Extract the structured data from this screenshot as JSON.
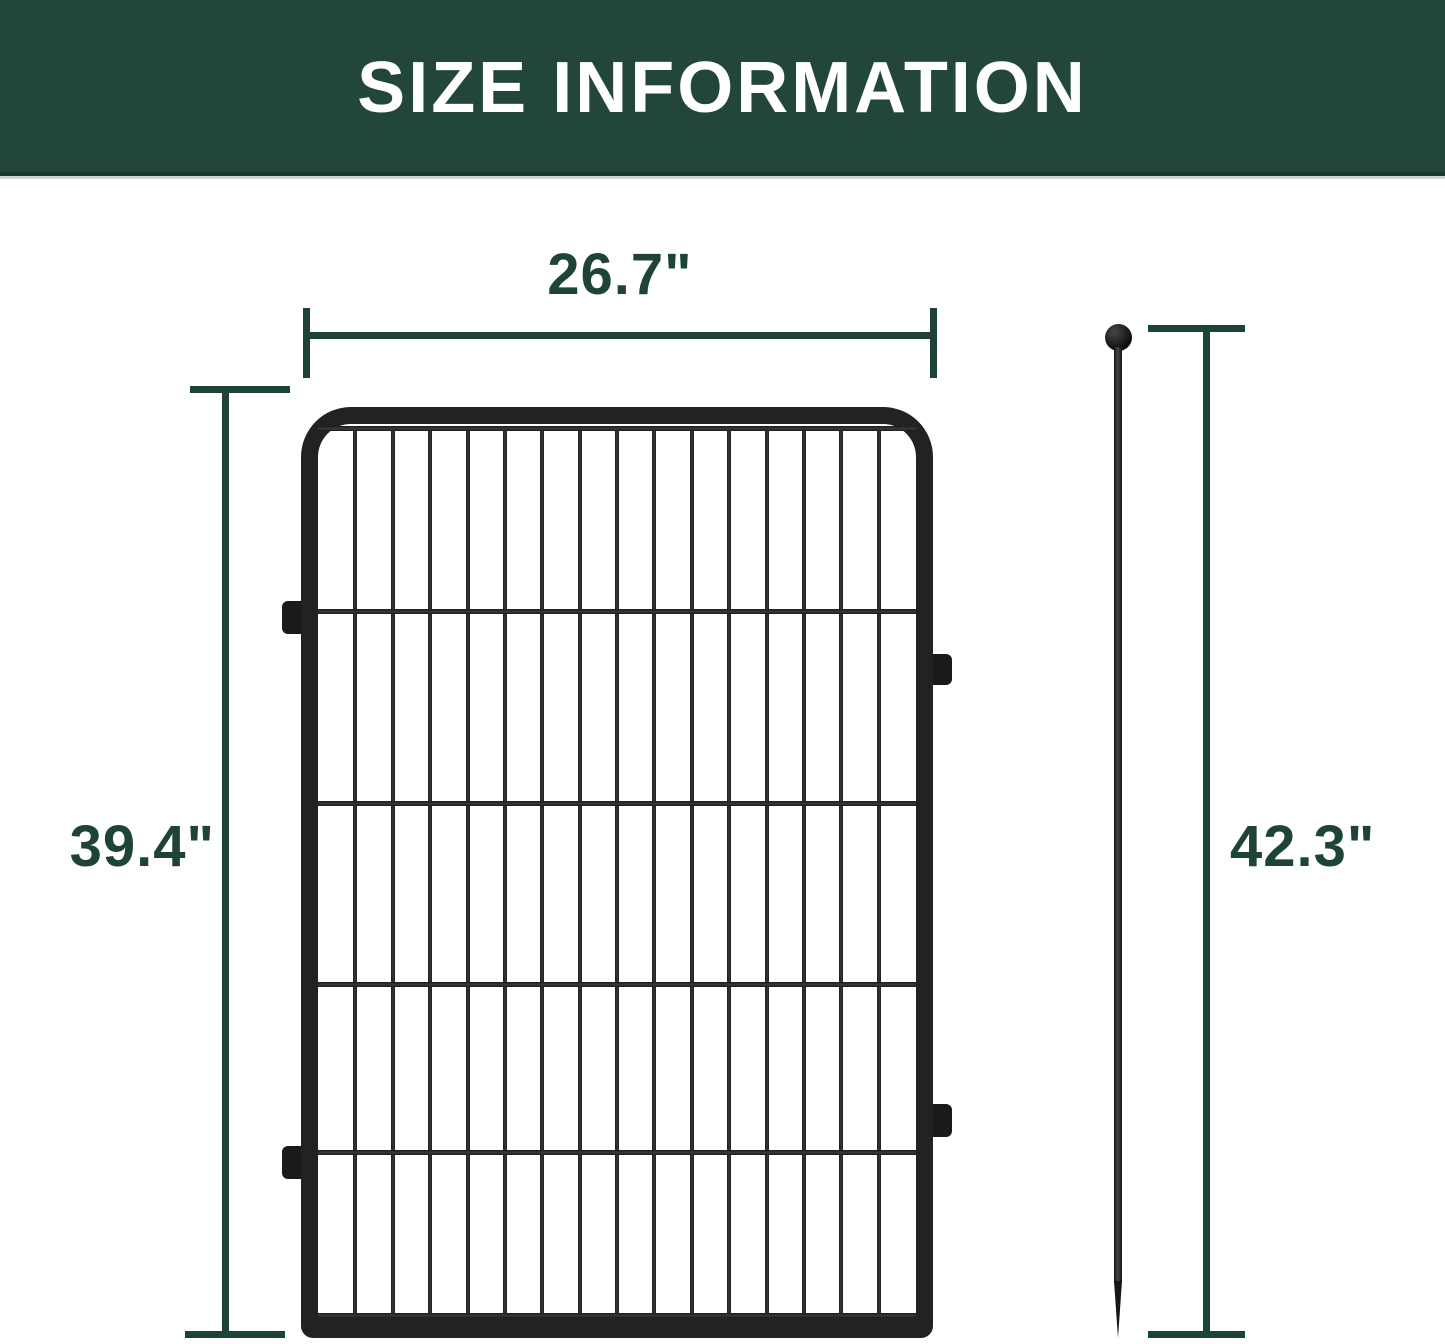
{
  "header": {
    "title": "SIZE INFORMATION"
  },
  "colors": {
    "banner_bg": "#224739",
    "banner_text": "#ffffff",
    "accent": "#1d4434",
    "fence_frame": "#202224"
  },
  "dimensions": {
    "panel_width": {
      "label": "26.7\""
    },
    "panel_height": {
      "label": "39.4\""
    },
    "stake_height": {
      "label": "42.3\""
    }
  },
  "fence": {
    "vertical_wires": 15,
    "horizontal_wire_offsets_px": [
      2,
      185,
      377,
      558,
      726,
      889
    ]
  }
}
